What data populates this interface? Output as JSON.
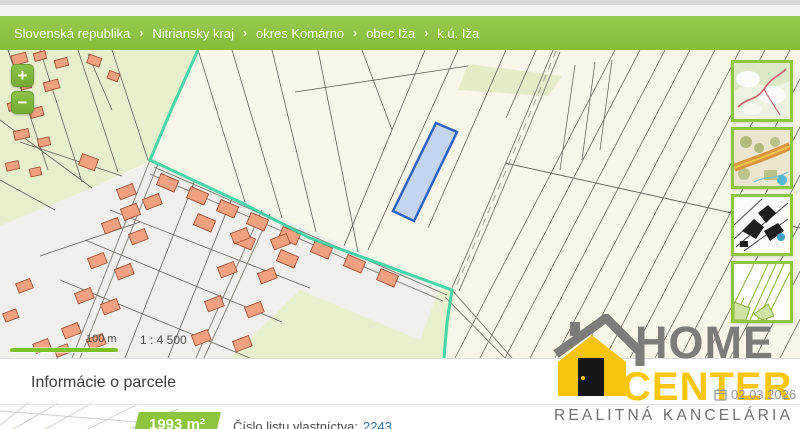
{
  "breadcrumb": {
    "separator": "›",
    "items": [
      "Slovenská republika",
      "Nitriansky kraj",
      "okres Komárno",
      "obec Iža",
      "k.ú. Iža"
    ]
  },
  "map": {
    "zoom_in_glyph": "+",
    "zoom_out_glyph": "−",
    "scale_bar_label": "100 m",
    "scale_ratio": "1 : 4 500",
    "accent_green": "#8cc63e",
    "boundary_color": "#36d2a2",
    "highlight_parcel_color": "#2e62c4",
    "building_color": "#f1a17f"
  },
  "panel": {
    "title": "Informácie o parcele",
    "area_badge": "1993 m²",
    "lv_label": "Číslo listu vlastníctva:",
    "lv_number": "2243"
  },
  "watermark": {
    "brand_top": "HOME",
    "brand_bottom": "CENTER",
    "brand_sub": "REALITNÁ  KANCELÁRIA",
    "date": "02.03.2026"
  }
}
